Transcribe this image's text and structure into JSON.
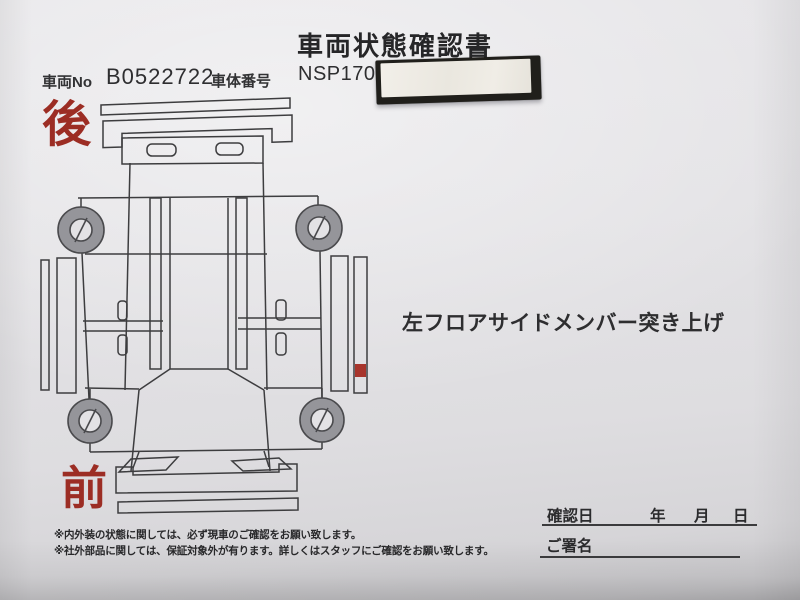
{
  "title": "車両状態確認書",
  "header": {
    "vehicle_no_label": "車両No",
    "vehicle_no_value": "B0522722",
    "vin_label": "車体番号",
    "vin_prefix": "NSP170-"
  },
  "diagram": {
    "rear_label": "後",
    "front_label": "前",
    "damage_note": "左フロアサイドメンバー突き上げ"
  },
  "footnotes": [
    "※内外装の状態に関しては、必ず現車のご確認をお願い致します。",
    "※社外部品に関しては、保証対象外が有ります。詳しくはスタッフにご確認をお願い致します。"
  ],
  "confirmation": {
    "date_label": "確認日",
    "year_label": "年",
    "month_label": "月",
    "day_label": "日",
    "signature_label": "ご署名"
  },
  "colors": {
    "accent_red": "#9c2d24",
    "damage_mark_red": "#a8352c",
    "diagram_line": "#3d3d3f",
    "wheel_gray": "#95959a",
    "wheel_outline": "#4a4a4d",
    "paper": "#e2e1e4",
    "sticker_face": "#efece5",
    "sticker_frame": "#201f1b"
  }
}
